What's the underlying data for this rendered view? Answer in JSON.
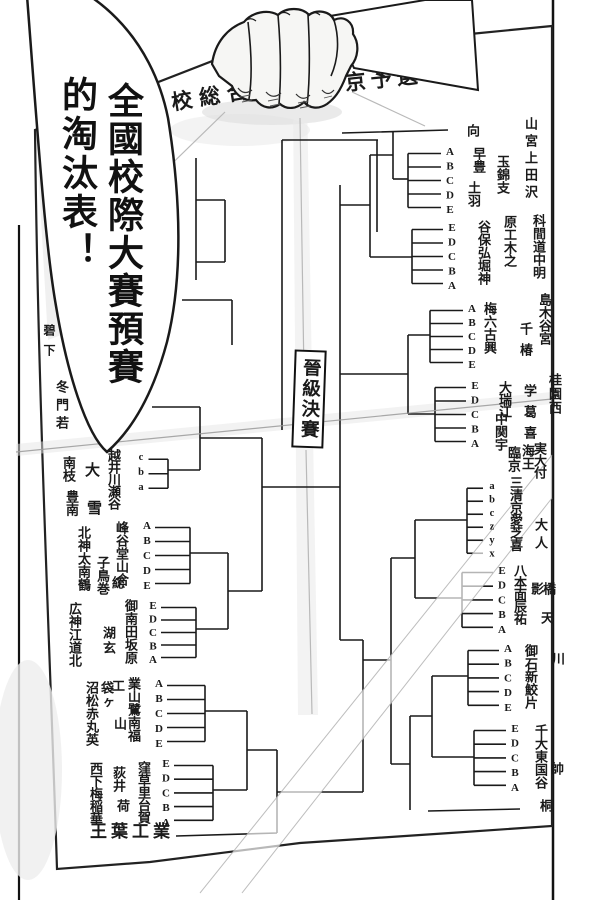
{
  "page": {
    "bg": "#ffffff",
    "ink": "#1a1a1a"
  },
  "speech_bubble": {
    "col_right": "全國校際大賽預賽",
    "col_left": "的淘汰表！"
  },
  "paper": {
    "title_left": "校総合",
    "title_right": "東京予選",
    "center_label": "晉級決賽",
    "name_columns": [
      {
        "t": "向",
        "x": 465,
        "y": 124
      },
      {
        "t": "早豊",
        "x": 471,
        "y": 147
      },
      {
        "t": "土羽",
        "x": 466,
        "y": 181
      },
      {
        "t": "玉錦支",
        "x": 495,
        "y": 155
      },
      {
        "t": "山宮上田沢",
        "x": 523,
        "y": 117,
        "dy": 17
      },
      {
        "t": "谷保弘堀神",
        "x": 476,
        "y": 220
      },
      {
        "t": "原工木之",
        "x": 502,
        "y": 215
      },
      {
        "t": "科間道中明",
        "x": 531,
        "y": 214
      },
      {
        "t": "梅六古興",
        "x": 482,
        "y": 302
      },
      {
        "t": "千椿",
        "x": 518,
        "y": 322,
        "dy": 21
      },
      {
        "t": "島木谷宮",
        "x": 537,
        "y": 293
      },
      {
        "t": "大瑞江",
        "x": 497,
        "y": 381,
        "dy": 12
      },
      {
        "t": "中関宇",
        "x": 493,
        "y": 412
      },
      {
        "t": "学葛喜",
        "x": 522,
        "y": 384,
        "dy": 21
      },
      {
        "t": "桂園西",
        "x": 547,
        "y": 373,
        "dy": 14
      },
      {
        "t": "臨京",
        "x": 506,
        "y": 446
      },
      {
        "t": "海王",
        "x": 520,
        "y": 444
      },
      {
        "t": "実大付",
        "x": 532,
        "y": 442,
        "dy": 12
      },
      {
        "t": "三清京愛芝喜",
        "x": 508,
        "y": 476,
        "dy": 12.5
      },
      {
        "t": "大人",
        "x": 533,
        "y": 518,
        "dy": 18
      },
      {
        "t": "八本面辰祐",
        "x": 512,
        "y": 564,
        "dy": 12
      },
      {
        "t": "影",
        "x": 529,
        "y": 582
      },
      {
        "t": "橋",
        "x": 541,
        "y": 582
      },
      {
        "t": "天",
        "x": 539,
        "y": 611
      },
      {
        "t": "御石新鮫片",
        "x": 523,
        "y": 644
      },
      {
        "t": "川",
        "x": 550,
        "y": 652
      },
      {
        "t": "千大東国谷",
        "x": 533,
        "y": 724
      },
      {
        "t": "桐",
        "x": 538,
        "y": 799
      },
      {
        "t": "帥",
        "x": 549,
        "y": 762
      },
      {
        "t": "碧下",
        "x": 43,
        "y": 324,
        "fs": 12,
        "dy": 20
      },
      {
        "t": "冬門若",
        "x": 54,
        "y": 380,
        "dy": 18
      },
      {
        "t": "南枝",
        "x": 61,
        "y": 456
      },
      {
        "t": "豊南",
        "x": 64,
        "y": 490
      },
      {
        "t": "北神太南鶴",
        "x": 76,
        "y": 526
      },
      {
        "t": "広神江道北",
        "x": 67,
        "y": 602
      },
      {
        "t": "大",
        "x": 84,
        "y": 462,
        "fs": 15
      },
      {
        "t": "雪",
        "x": 86,
        "y": 500,
        "fs": 15
      },
      {
        "t": "子鳥巻",
        "x": 95,
        "y": 556
      },
      {
        "t": "総",
        "x": 110,
        "y": 576
      },
      {
        "t": "湖玄",
        "x": 101,
        "y": 626,
        "dy": 15
      },
      {
        "t": "越井川瀬谷",
        "x": 106,
        "y": 449,
        "dy": 12
      },
      {
        "t": "峰谷堂山合",
        "x": 114,
        "y": 521
      },
      {
        "t": "御南田坂原",
        "x": 123,
        "y": 599
      },
      {
        "t": "沼松赤丸英",
        "x": 84,
        "y": 681
      },
      {
        "t": "袋ヶ",
        "x": 99,
        "y": 681,
        "dy": 15
      },
      {
        "t": "工",
        "x": 110,
        "y": 679
      },
      {
        "t": "山",
        "x": 112,
        "y": 717
      },
      {
        "t": "業山鷺南福",
        "x": 126,
        "y": 677
      },
      {
        "t": "西下梅稲華",
        "x": 88,
        "y": 762,
        "dy": 12.5
      },
      {
        "t": "荻井",
        "x": 111,
        "y": 766
      },
      {
        "t": "荷",
        "x": 115,
        "y": 799
      },
      {
        "t": "窪草里台賀",
        "x": 136,
        "y": 761,
        "dy": 12.5
      },
      {
        "t": "王葉工業",
        "x": 90,
        "y": 824,
        "fs": 17,
        "h": true,
        "ls": 4
      }
    ],
    "clusters": [
      {
        "letters": "cba",
        "x": 135,
        "y0": 452,
        "dy": 14.5,
        "side": "L",
        "vert": 168,
        "stub": [
          470,
          200
        ],
        "fs": 10.5
      },
      {
        "letters": "ABCDE",
        "x": 141,
        "y0": 520,
        "dy": 14,
        "side": "L",
        "vert": 190,
        "stub": [
          553,
          228
        ]
      },
      {
        "letters": "EDCBA",
        "x": 147,
        "y0": 600,
        "dy": 12.5,
        "side": "L",
        "vert": 196,
        "stub": [
          629,
          228
        ]
      },
      {
        "letters": "ABCDE",
        "x": 153,
        "y0": 678,
        "dy": 14,
        "side": "L",
        "vert": 205,
        "stub": [
          711,
          247
        ]
      },
      {
        "letters": "EDCBA",
        "x": 160,
        "y0": 758,
        "dy": 13.7,
        "side": "L",
        "vert": 213,
        "stub": [
          790,
          247
        ]
      },
      {
        "letters": "ABCDE",
        "x": 444,
        "y0": 146,
        "dy": 13.5,
        "side": "R",
        "vert": 408,
        "stub": [
          179,
          393
        ]
      },
      {
        "letters": "EDCBA",
        "x": 446,
        "y0": 222,
        "dy": 13.5,
        "side": "R",
        "vert": 412,
        "stub": [
          257,
          370
        ]
      },
      {
        "letters": "ABCDE",
        "x": 466,
        "y0": 303,
        "dy": 13,
        "side": "R",
        "vert": 430,
        "stub": [
          335,
          408
        ]
      },
      {
        "letters": "EDCBA",
        "x": 469,
        "y0": 380,
        "dy": 13.5,
        "side": "R",
        "vert": 435,
        "stub": [
          414,
          408
        ]
      },
      {
        "letters": "abczyx",
        "x": 486,
        "y0": 481,
        "dy": 13,
        "side": "R",
        "vert": 467,
        "stub": [
          520,
          415
        ],
        "fs": 10.5
      },
      {
        "letters": "EDCBA",
        "x": 496,
        "y0": 565,
        "dy": 13.7,
        "side": "R",
        "vert": 462,
        "stub": [
          598,
          415
        ]
      },
      {
        "letters": "ABCDE",
        "x": 502,
        "y0": 643,
        "dy": 13.7,
        "side": "R",
        "vert": 468,
        "stub": [
          676,
          432
        ]
      },
      {
        "letters": "EDCBA",
        "x": 509,
        "y0": 723,
        "dy": 13.7,
        "side": "R",
        "vert": 474,
        "stub": [
          757,
          432
        ]
      }
    ]
  }
}
